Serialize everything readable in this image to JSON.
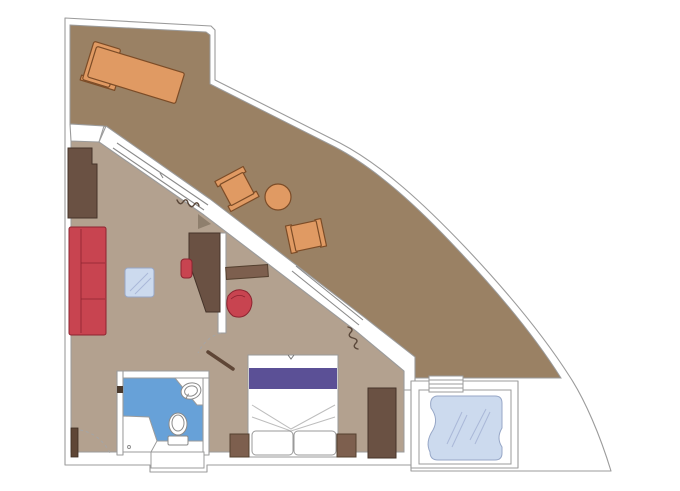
{
  "meta": {
    "title": "Ship suite floor plan",
    "description": "Top-down architectural floor plan of a cruise-ship suite with wrap-around terrace, living room, bedroom, bathroom and private whirlpool deck. No text labels are rendered on the plan."
  },
  "colors": {
    "wall_line": "#9b9b9b",
    "balcony_floor": "#9a8164",
    "interior_floor": "#b3a18f",
    "bathroom_floor": "#67a1d8",
    "glass_light": "#ccdaee",
    "glass_stroke": "#97a7c7",
    "furniture_dark": "#6a5143",
    "furniture_dark_stroke": "#45342a",
    "furniture_medium": "#7d5f4e",
    "furniture_medium_stroke": "#54402f",
    "sofa_red": "#c84450",
    "red_stroke": "#8c2430",
    "balcony_wood": "#e09a63",
    "balcony_wood_stroke": "#7c4c27",
    "bed_purple": "#5b5096",
    "linen_stroke": "#9a9a9a",
    "door_wood": "#5f4636",
    "curtain": "#5a4739",
    "fixture_stroke": "#8a8a8a",
    "shadow_taupe": "#8f7f6d"
  },
  "rooms": [
    {
      "id": "terrace",
      "name": "wrap-around terrace"
    },
    {
      "id": "living-room",
      "name": "living room"
    },
    {
      "id": "bedroom",
      "name": "bedroom"
    },
    {
      "id": "bathroom",
      "name": "bathroom"
    },
    {
      "id": "whirlpool-deck",
      "name": "whirlpool deck"
    }
  ],
  "furniture": [
    {
      "id": "sun-lounger",
      "room": "terrace"
    },
    {
      "id": "terrace-chair-1",
      "room": "terrace"
    },
    {
      "id": "terrace-chair-2",
      "room": "terrace"
    },
    {
      "id": "terrace-round-table",
      "room": "terrace"
    },
    {
      "id": "wardrobe-cabinet",
      "room": "living-room"
    },
    {
      "id": "sofa",
      "room": "living-room"
    },
    {
      "id": "glass-coffee-table",
      "room": "living-room"
    },
    {
      "id": "desk",
      "room": "living-room"
    },
    {
      "id": "desk-chair",
      "room": "living-room"
    },
    {
      "id": "console-shelf",
      "room": "bedroom"
    },
    {
      "id": "tub-chair",
      "room": "bedroom"
    },
    {
      "id": "double-bed",
      "room": "bedroom"
    },
    {
      "id": "nightstand-left",
      "room": "bedroom"
    },
    {
      "id": "nightstand-right",
      "room": "bedroom"
    },
    {
      "id": "bedroom-wardrobe",
      "room": "bedroom"
    },
    {
      "id": "sink",
      "room": "bathroom"
    },
    {
      "id": "toilet",
      "room": "bathroom"
    },
    {
      "id": "shower",
      "room": "bathroom"
    },
    {
      "id": "whirlpool-bath",
      "room": "whirlpool-deck"
    },
    {
      "id": "terrace-steps",
      "room": "whirlpool-deck"
    }
  ]
}
